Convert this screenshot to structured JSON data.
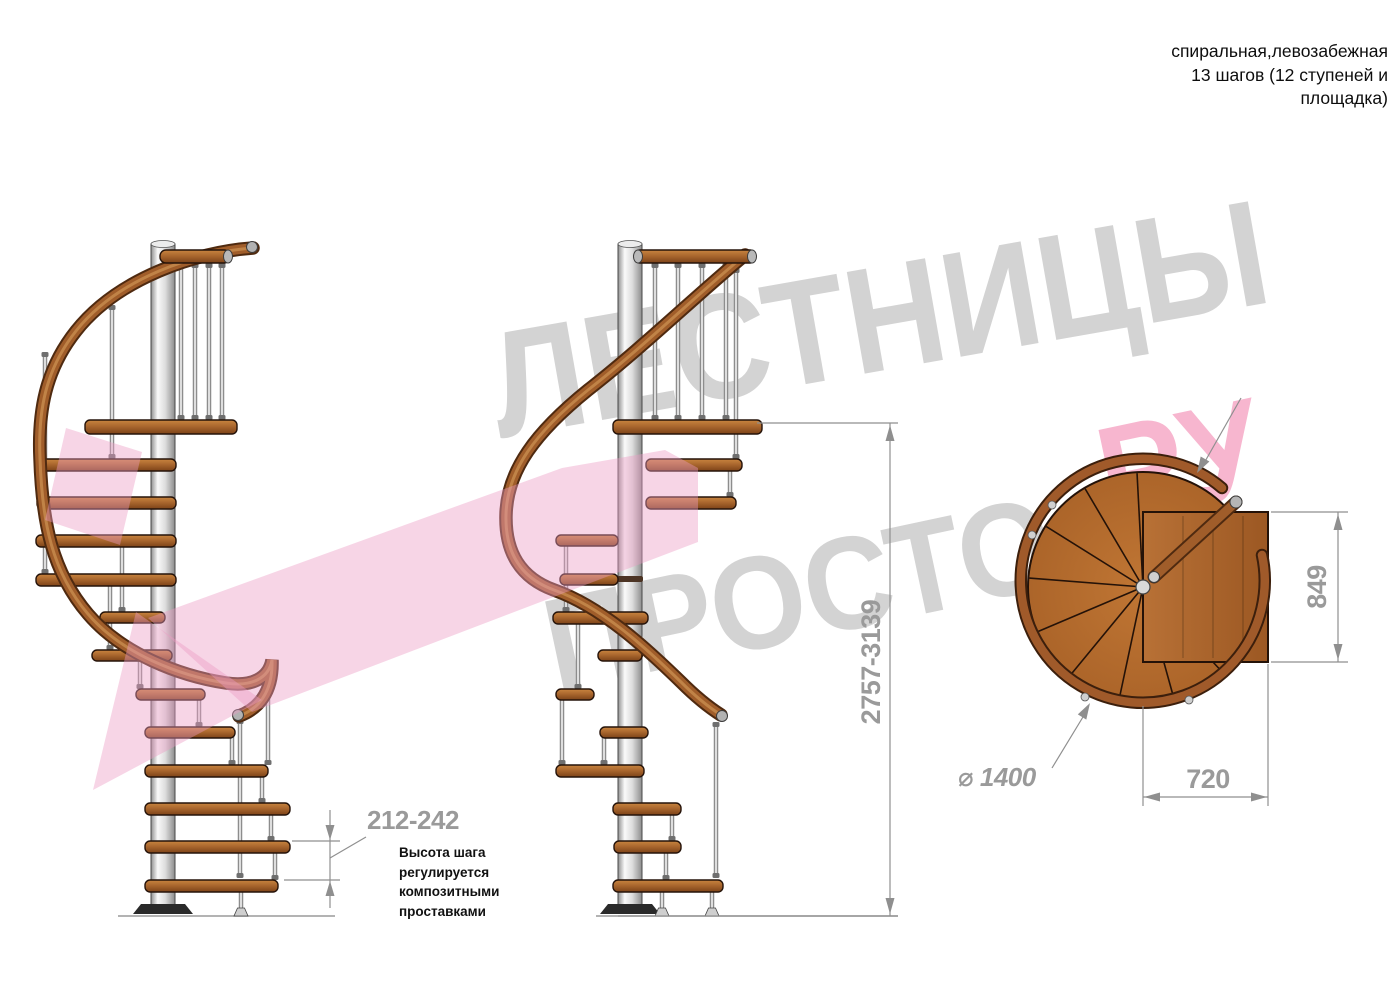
{
  "annotation": {
    "line1": "спиральная,левозабежная",
    "line2": "13 шагов (12 ступеней и",
    "line3": "площадка)"
  },
  "dimensions": {
    "total_height": "2757-3139",
    "step_height": "212-242",
    "platform_depth": "849",
    "platform_width": "720",
    "diameter": "⌀ 1400"
  },
  "note": {
    "line1": "Высота шага",
    "line2": "регулируется",
    "line3": "композитными",
    "line4": "проставками"
  },
  "watermark": {
    "word1": "ЛЕСТНИЦЫ",
    "word2": "ПРОСТО",
    "word2_suffix": ".РУ"
  },
  "colors": {
    "wood": "#a05d2a",
    "wood_dark": "#4f2a10",
    "steel": "#d9d9d9",
    "watermark_gray": "#d3d3d3",
    "watermark_pink": "#f7b6cf",
    "arrow_pink": "#ec9cc4",
    "dimension_gray": "#9a9a9a"
  }
}
